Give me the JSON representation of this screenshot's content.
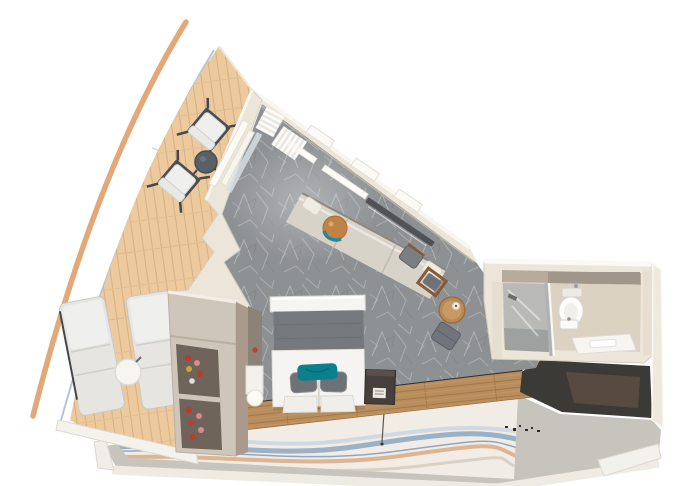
{
  "scene": {
    "name": "cruise-ship-balcony-stateroom-floorplan",
    "view": "top-down-3d-cutaway-render",
    "rooms": [
      "balcony",
      "bedroom",
      "bathroom",
      "corridor"
    ]
  },
  "colors": {
    "background": "#ffffff",
    "hull": "#e2a878",
    "deck": "#ecca9e",
    "deck_edge": "#aebfd2",
    "wall": "#ece6da",
    "wall_highlight": "#f8f6f1",
    "carpet": "#8e9194",
    "sofa": "#d8d3c8",
    "ottoman": "#bf8347",
    "ottoman_ring": "#2f8691",
    "headboard": "#75787d",
    "bed": "#f5f4f2",
    "pillow": "#6e7175",
    "accent_pillow": "#0c7f8d",
    "wood_floor": "#b98e5e",
    "wardrobe": "#cfc6ba",
    "wardrobe_interior": "#6e6459",
    "shoes": "#c0392b",
    "cube": "#45403b",
    "corridor": "#c7c3bd",
    "runner": "#f1ede6",
    "wave_blue": "#8ba6c2",
    "wave_tan": "#d8a67e",
    "dark_wall": "#3c3a37",
    "door": "#5a4e43",
    "bath_floor": "#dbd2c2",
    "shower": "#9fa0a0",
    "glass": "#d7dde2",
    "lounger": "#e6e5e2",
    "chair_seat": "#eff0ee",
    "chair_frame": "#44474b",
    "balcony_table": "#596066",
    "tv": "#515257"
  },
  "balcony": {
    "floor": "wood-plank-deck",
    "items": [
      "deck-chair",
      "deck-chair",
      "round-coffee-table",
      "sun-lounger",
      "sun-lounger",
      "round-side-table"
    ]
  },
  "bedroom": {
    "floor": "gray-patterned-carpet",
    "items": [
      "double-bed-with-teal-pillow",
      "overhead-shelf",
      "headboard",
      "nightstand",
      "minibar-cube",
      "open-wardrobe-with-shoes",
      "wall-sofa",
      "round-ottoman",
      "wall-tv",
      "desk-chairs",
      "round-stool",
      "pouf"
    ]
  },
  "bathroom": {
    "floor": "beige-vinyl",
    "items": [
      "glass-shower",
      "toilet",
      "sink",
      "bath-mat",
      "towel",
      "vanity-counter"
    ]
  },
  "corridor": {
    "floor": "gray-with-wave-pattern-runner",
    "items": [
      "wave-runner-carpet",
      "cabin-entry-door"
    ]
  }
}
